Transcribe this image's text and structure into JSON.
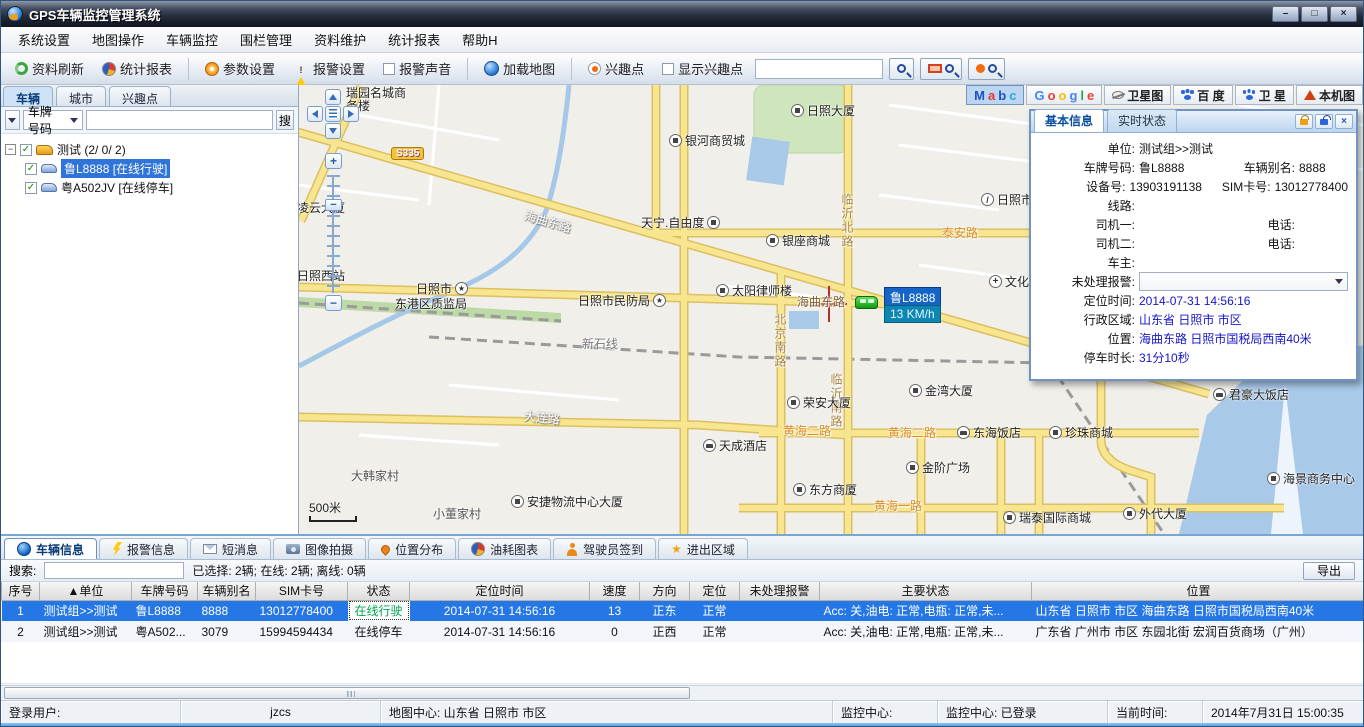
{
  "window": {
    "title": "GPS车辆监控管理系统",
    "min": "–",
    "max": "□",
    "close": "×"
  },
  "menu": {
    "items": [
      "系统设置",
      "地图操作",
      "车辆监控",
      "围栏管理",
      "资料维护",
      "统计报表",
      "帮助H"
    ]
  },
  "toolbar": {
    "refresh": "资料刷新",
    "report": "统计报表",
    "params": "参数设置",
    "alarm": "报警设置",
    "sound": "报警声音",
    "loadmap": "加载地图",
    "poi": "兴趣点",
    "showpoi": "显示兴趣点"
  },
  "map_bar": {
    "mapabc": [
      "M",
      "a",
      "b",
      "c"
    ],
    "google": [
      "G",
      "o",
      "o",
      "g",
      "l",
      "e"
    ],
    "satellite": "卫星图",
    "baidu": "百 度",
    "baidu_sat": "卫 星",
    "local": "本机图"
  },
  "left_panel": {
    "tabs": [
      "车辆",
      "城市",
      "兴趣点"
    ],
    "field_selector": "车牌号码",
    "search_button": "搜",
    "check": "✓",
    "expander": "−",
    "group_label": "测试 (2/ 0/ 2)",
    "vehicles": [
      {
        "label": "鲁L8888 [在线行驶]"
      },
      {
        "label": "粤A502JV [在线停车]"
      }
    ]
  },
  "info_panel": {
    "tabs": [
      "基本信息",
      "实时状态"
    ],
    "close": "×",
    "fields": {
      "unit_l": "单位:",
      "unit_v": "测试组>>测试",
      "plate_l": "车牌号码:",
      "plate_v": "鲁L8888",
      "alias_l": "车辆别名:",
      "alias_v": "8888",
      "dev_l": "设备号:",
      "dev_v": "13903191138",
      "sim_l": "SIM卡号:",
      "sim_v": "13012778400",
      "line_l": "线路:",
      "line_v": "",
      "drv1_l": "司机一:",
      "drv1_v": "",
      "tel1_l": "电话:",
      "tel1_v": "",
      "drv2_l": "司机二:",
      "drv2_v": "",
      "tel2_l": "电话:",
      "tel2_v": "",
      "owner_l": "车主:",
      "owner_v": "",
      "alarm_l": "未处理报警:",
      "alarm_v": "",
      "time_l": "定位时间:",
      "time_v": "2014-07-31 14:56:16",
      "region_l": "行政区域:",
      "region_v": "山东省 日照市 市区",
      "pos_l": "位置:",
      "pos_v": "海曲东路 日照市国税局西南40米",
      "park_l": "停车时长:",
      "park_v": "31分10秒"
    }
  },
  "map": {
    "scale": "500米",
    "shield": "S335",
    "zoom_in": "+",
    "zoom_out": "−",
    "slider": "−",
    "marker_plate": "鲁L8888",
    "marker_speed": "13 KM/h",
    "road_labels": [
      "海曲东路",
      "海曲东路",
      "临沂北路",
      "北京南路",
      "临沂南路",
      "泰安路",
      "新石线",
      "大连路",
      "黄海二路",
      "黄海二路",
      "黄海一路"
    ],
    "pois": [
      "瑞园名城商务楼",
      "银河商贸城",
      "日照大厦",
      "凌云大厦",
      "天宁.自由度",
      "银座商城",
      "日照市新营中",
      "太阳律师楼",
      "日照市民防局",
      "日照市",
      "东港区质监局",
      "日照西站",
      "文化",
      "金湾大厦",
      "荣安大厦",
      "君豪大饭店",
      "东海饭店",
      "珍珠商城",
      "天成酒店",
      "金阶广场",
      "东方商厦",
      "安捷物流中心大厦",
      "瑞泰国际商城",
      "外代大厦",
      "海景商务中心",
      "大韩家村",
      "小董家村"
    ]
  },
  "bottom": {
    "tabs": [
      "车辆信息",
      "报警信息",
      "短消息",
      "图像拍摄",
      "位置分布",
      "油耗图表",
      "驾驶员签到",
      "进出区域"
    ],
    "search_label": "搜索:",
    "summary": "已选择: 2辆;  在线: 2辆;  离线: 0辆",
    "export_button": "导出",
    "table": {
      "headers": [
        "序号",
        "▲单位",
        "车牌号码",
        "车辆别名",
        "SIM卡号",
        "状态",
        "定位时间",
        "速度",
        "方向",
        "定位",
        "未处理报警",
        "主要状态",
        "位置"
      ],
      "rows": [
        {
          "cells": [
            "1",
            "测试组>>测试",
            "鲁L8888",
            "8888",
            "13012778400",
            "在线行驶",
            "2014-07-31 14:56:16",
            "13",
            "正东",
            "正常",
            "",
            "Acc: 关,油电: 正常,电瓶: 正常,未...",
            "山东省 日照市 市区 海曲东路 日照市国税局西南40米"
          ]
        },
        {
          "cells": [
            "2",
            "测试组>>测试",
            "粤A502...",
            "3079",
            "15994594434",
            "在线停车",
            "2014-07-31 14:56:16",
            "0",
            "正西",
            "正常",
            "",
            "Acc: 关,油电: 正常,电瓶: 正常,未...",
            "广东省 广州市 市区 东园北街 宏润百货商场（广州）"
          ]
        }
      ]
    }
  },
  "status_bar": {
    "login_label": "登录用户:",
    "login_user": "jzcs",
    "map_center": "地图中心: 山东省 日照市 市区",
    "monitor_label": "监控中心:",
    "monitor_status": "监控中心: 已登录",
    "time_label": "当前时间:",
    "time_value": "2014年7月31日 15:00:35"
  }
}
